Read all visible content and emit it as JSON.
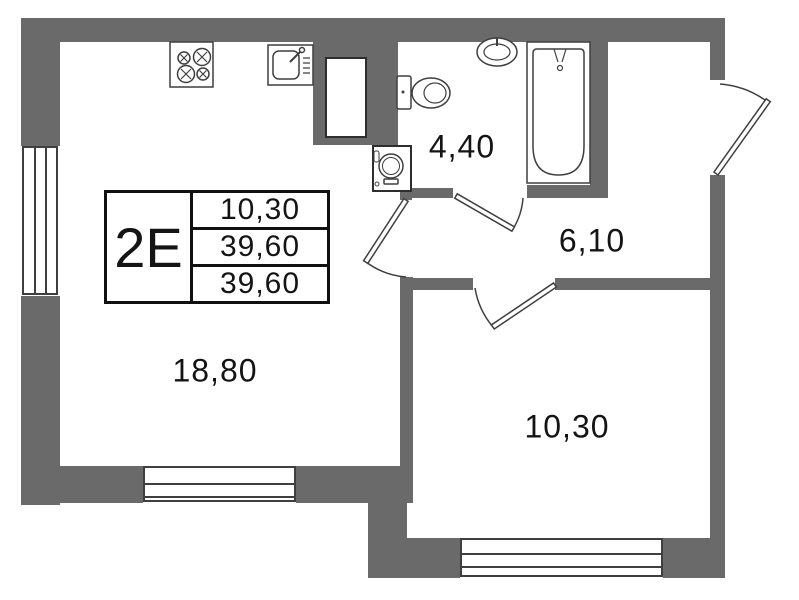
{
  "plan_title": "apartment-floor-plan",
  "unit_card": {
    "unit_label": "2Е",
    "rows": [
      "10,30",
      "39,60",
      "39,60"
    ]
  },
  "rooms": {
    "living_kitchen": {
      "area": "18,80"
    },
    "bathroom": {
      "area": "4,40"
    },
    "hallway": {
      "area": "6,10"
    },
    "bedroom": {
      "area": "10,30"
    }
  },
  "fixtures": [
    "stove",
    "kitchen-sink",
    "vent-shaft",
    "washing-machine",
    "toilet",
    "wash-basin",
    "bathtub"
  ],
  "colors": {
    "wall": "#6a6a6a",
    "line": "#3f3f3f",
    "text": "#141414",
    "background": "#ffffff"
  }
}
